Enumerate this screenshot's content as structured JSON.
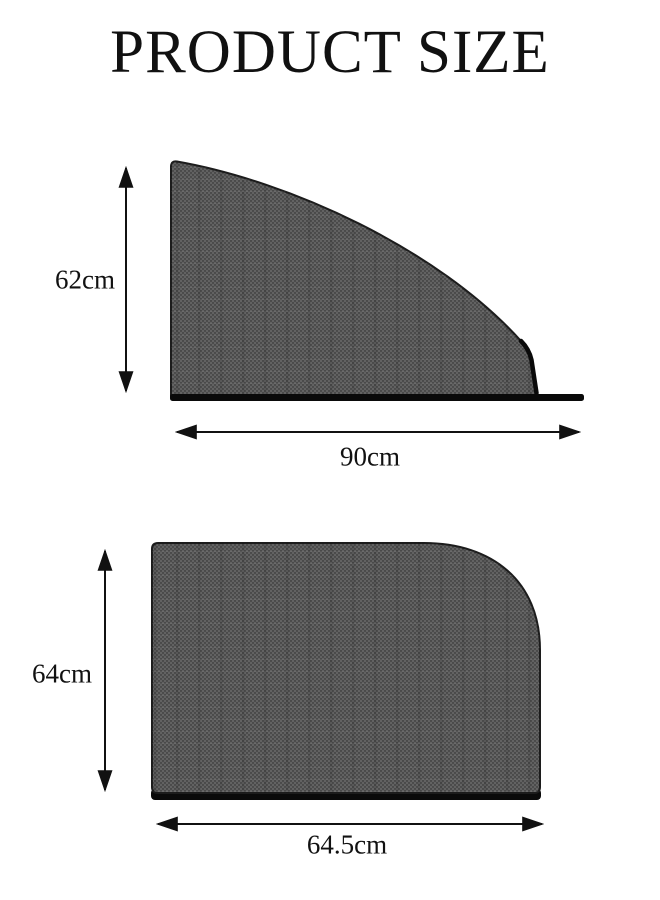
{
  "title": "PRODUCT SIZE",
  "diagrams": [
    {
      "id": "front-window-shade",
      "shape": "curved triangular side-window sunshade with mesh texture",
      "height_label": "62cm",
      "width_label": "90cm"
    },
    {
      "id": "rear-window-shade",
      "shape": "rectangular sunshade with large rounded top-right corner, mesh texture",
      "height_label": "64cm",
      "width_label": "64.5cm"
    }
  ],
  "colors": {
    "background": "#ffffff",
    "text": "#111111",
    "outline": "#1c1c1c",
    "mesh": "#535353",
    "mesh_dot_light": "#6c6c6c",
    "mesh_dot_dark": "#3e3e3e",
    "bar": "#0a0a0a",
    "arrow": "#111111"
  }
}
